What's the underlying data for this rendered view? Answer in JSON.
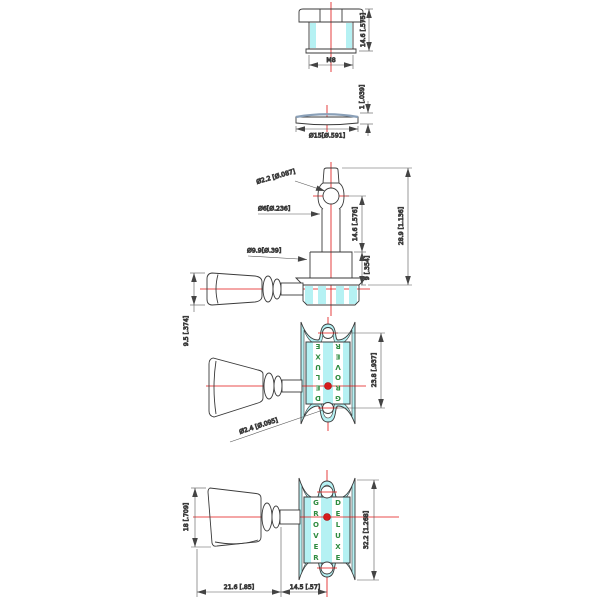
{
  "drawing": {
    "description": "Technical dimension drawing of a Grover Deluxe guitar tuning machine (bushing, washer, side elevation, front view, bottom view)",
    "colors": {
      "highlight_cyan": "#b5f1f3",
      "centerline_red": "#e01010",
      "brand_green": "#2e8b3f",
      "line": "#3a3a3a",
      "washer_top": "#8aa0b8"
    },
    "brand": {
      "line1": "GROVER",
      "line2": "DELUXE"
    },
    "views": {
      "bushing": {
        "dim_height": "14.6 [.575]",
        "dim_thread": "M8"
      },
      "washer": {
        "dim_thickness": "1 [.039]",
        "dim_diameter": "Ø15[Ø.591]"
      },
      "side": {
        "dim_hole": "Ø2.2 [Ø.087]",
        "dim_post": "Ø6[Ø.236]",
        "dim_base": "Ø9.9[Ø.39]",
        "dim_post_height": "14.6 [.576]",
        "dim_base_height": "9 [.354]",
        "dim_total_height": "28.9 [1.136]",
        "dim_button_thickness": "9.5 [.374]"
      },
      "front": {
        "dim_hole_spacing": "23.8 [.937]",
        "dim_screw_hole": "Ø2.4 [Ø.095]",
        "plate_left_text": "DELUXE",
        "plate_right_text": "GROVER"
      },
      "bottom": {
        "dim_button_width": "18 [.709]",
        "dim_plate_length": "32.2 [1.268]",
        "dim_button_length": "21.6 [.85]",
        "dim_center_offset": "14.5 [.57]",
        "plate_left_text": "GROVER",
        "plate_right_text": "DELUXE"
      }
    }
  }
}
